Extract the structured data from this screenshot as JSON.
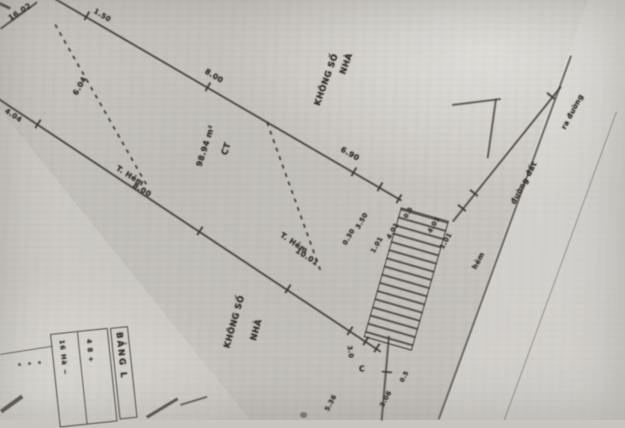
{
  "palette": {
    "paper": "#c8c5c0",
    "ink": "#38342f"
  },
  "annotations": [
    {
      "text": "16.02"
    },
    {
      "text": "1.50"
    },
    {
      "text": "8.00"
    },
    {
      "text": "6.90"
    },
    {
      "text": "6.04"
    },
    {
      "text": "4.04"
    },
    {
      "text": "NHÀ"
    },
    {
      "text": "KHÔNG SỐ"
    },
    {
      "text": "98.94 m²"
    },
    {
      "text": "CT"
    },
    {
      "text": "T. Hẻm"
    },
    {
      "text": "8.00"
    },
    {
      "text": "T. Hẻm"
    },
    {
      "text": "10.01"
    },
    {
      "text": "KHÔNG SỐ"
    },
    {
      "text": "NHÀ"
    },
    {
      "text": "3.50"
    },
    {
      "text": "0.30"
    },
    {
      "text": "1.01"
    },
    {
      "text": "4.01"
    },
    {
      "text": "0.5"
    },
    {
      "text": "4.01"
    },
    {
      "text": "1.01"
    },
    {
      "text": "5.36"
    },
    {
      "text": "3.06"
    },
    {
      "text": "0.5"
    },
    {
      "text": "C"
    },
    {
      "text": "3.0"
    },
    {
      "text": "đường đất"
    },
    {
      "text": "ra đường"
    },
    {
      "text": "hẻm"
    }
  ],
  "table": {
    "title": "BẢNG L",
    "col1": "16 Hà −",
    "col2": "4 8 +"
  }
}
